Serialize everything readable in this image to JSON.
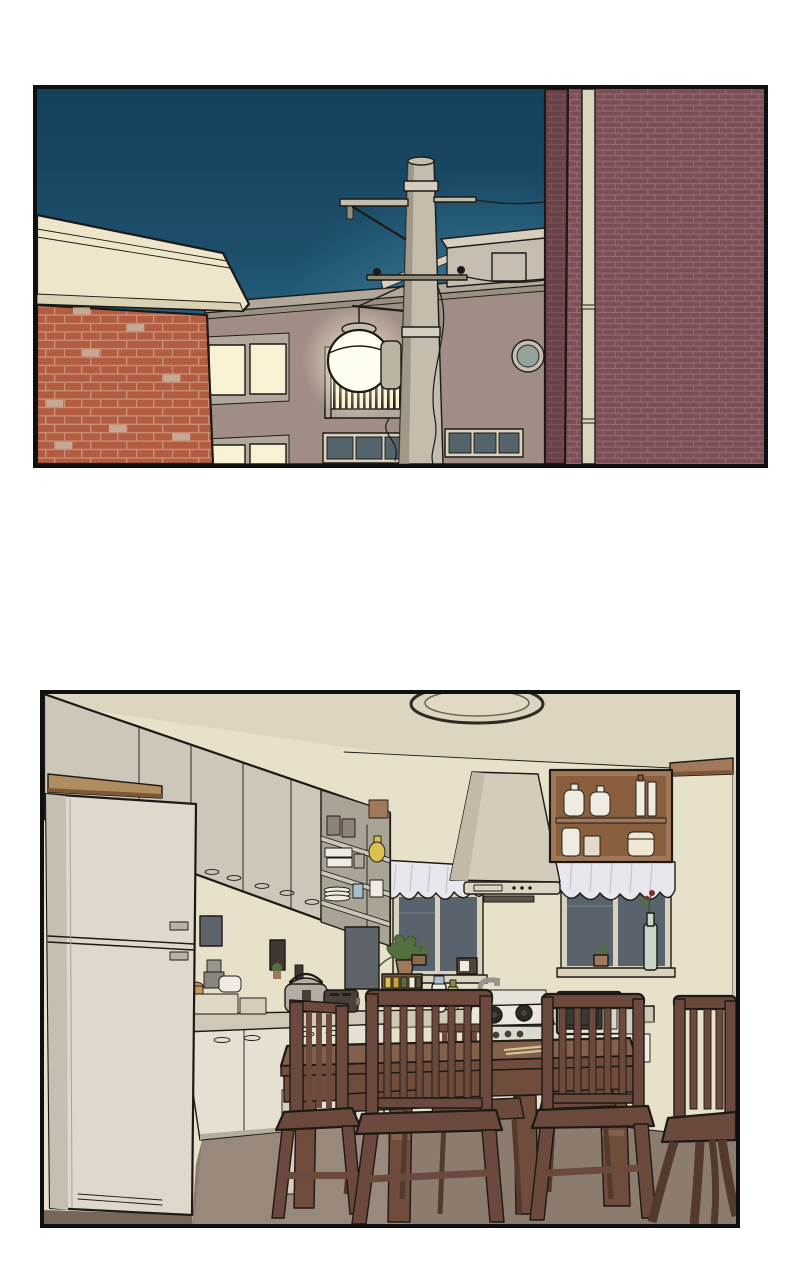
{
  "page": {
    "kind": "webtoon-comic-page",
    "panel_count": 2,
    "text_content": "none"
  },
  "panels": [
    {
      "id": "street-night",
      "alt": "Night exterior scene: a glowing street lamp on a concrete utility pole stands between an orange-brick building with a cream parapet, a beige apartment block with lit windows, a balcony and a round porthole window, and a dark maroon brick building, all under a deep teal evening sky.",
      "objects": [
        "night-sky",
        "horizon-glow",
        "orange-brick-building",
        "cream-parapet",
        "apartment-building",
        "lit-windows",
        "dark-windows",
        "balcony-railing",
        "street-lamp-globe",
        "rooftop-penthouse",
        "porthole-window",
        "utility-pole",
        "cross-arms",
        "insulators",
        "transformer-boxes",
        "power-lines",
        "maroon-brick-building",
        "drain-pipe"
      ]
    },
    {
      "id": "kitchen-interior",
      "alt": "Empty kitchen at night: a white refrigerator on the left, beige upper cabinets with open shelves holding canisters, plates and a yellow vase, a range hood, a wooden cabinet with white jars, two dark windows with pale valances, potted plants, a spice rack, rice cooker, toaster, thermos, gas stove and microwave on the counter, and a dark wooden dining table surrounded by slat-back chairs.",
      "objects": [
        "ceiling-light",
        "ceiling",
        "upper-cabinets",
        "open-shelves",
        "grey-canisters",
        "plate-stack",
        "blue-cup",
        "yellow-vase",
        "over-fridge-cabinet",
        "wood-board",
        "refrigerator",
        "range-hood",
        "wood-wall-cabinet",
        "white-jars",
        "window-left",
        "window-right",
        "curtain-valances",
        "hanging-plant",
        "succulent-plant",
        "green-bottle-with-flower",
        "wall-mirror",
        "picture-frames",
        "wall-outlet",
        "spice-rack",
        "kitchen-clock",
        "rice-cooker",
        "toaster",
        "thermos",
        "oil-bottle",
        "faucet",
        "kitchen-counter",
        "lower-cabinets",
        "gas-stove",
        "microwave",
        "dining-table",
        "chopsticks",
        "slat-back-chairs",
        "floor"
      ]
    }
  ],
  "palette": {
    "page_bg": "#ffffff",
    "panel_border": "#101010",
    "ink": "#1d1915",
    "sky_top": "#14405a",
    "sky_mid": "#1d4f6c",
    "sky_low": "#2e7592",
    "sky_horizon": "#3a86a0",
    "sky_glow": "#4e9ab2",
    "cream_parapet": "#ede6cb",
    "cream_parapet_dark": "#d9d2b4",
    "brick_orange": "#b25c41",
    "brick_orange_mortar": "#ca8f74",
    "brick_orange_patch": "#c9b29e",
    "bldg_mauve": "#a08d86",
    "band_grey": "#b1a89b",
    "band_grey_dark": "#99907f",
    "penthouse": "#c5beb0",
    "penthouse_light": "#d6cfc0",
    "window_lit": "#f8f1d3",
    "window_dark": "#55646a",
    "window_frame": "#d8d1bd",
    "porthole": "#95a39d",
    "pole": "#c4bdae",
    "pole_shadow": "#948d7c",
    "pole_band": "#d3cdbf",
    "transformer": "#b9b3a4",
    "lamp_white": "#fffdf0",
    "brick_maroon": "#7d4f55",
    "brick_maroon_dark": "#69414a",
    "brick_maroon_mortar": "#976f77",
    "brick_maroon_mortar_dark": "#7b545c",
    "pipe_cream": "#d9d2bd",
    "ceiling": "#dcd5bf",
    "wall": "#e8e1ca",
    "wall_dark": "#d9d2bb",
    "cab_upper": "#cdc7b9",
    "cab_upper_dark": "#aaa496",
    "cab_lower": "#e6e0d2",
    "fridge_front": "#ded8cd",
    "fridge_side": "#c5bfb2",
    "wood": "#a1795a",
    "wood_dark": "#7c5838",
    "wood_deep": "#8a5f3e",
    "wood_board": "#b08d5e",
    "hood": "#d4cbba",
    "hood_shade": "#c2b9a8",
    "curtain": "#e9e7ee",
    "curtain_shadow": "#c9c6d4",
    "glass_dark": "#59636d",
    "counter": "#cfc8b6",
    "counter_edge": "#8a8374",
    "appliance_grey": "#b4aea2",
    "appliance_dark": "#463f38",
    "white_item": "#f0ebe0",
    "steel": "#9a948a",
    "frame_dark": "#3e3831",
    "mirror_glass": "#5f646a",
    "table_wood": "#6f4c3c",
    "table_wood_light": "#82604c",
    "chair_wood": "#6b4a3d",
    "chair_wood_dark": "#53392e",
    "chopstick": "#d8c492",
    "floor": "#8c7b6f",
    "floor_light": "#b3a498",
    "floor_shadow": "#756659",
    "plant_green": "#55703f",
    "plant_dark": "#3c5230",
    "bottle_pale": "#c7d6c6",
    "flower_red": "#7e2f2c",
    "accent_yellow": "#d9c24f",
    "accent_amber": "#c8a23c",
    "accent_blue": "#a9c0d2",
    "accent_green_bottle": "#c9cf6a"
  }
}
